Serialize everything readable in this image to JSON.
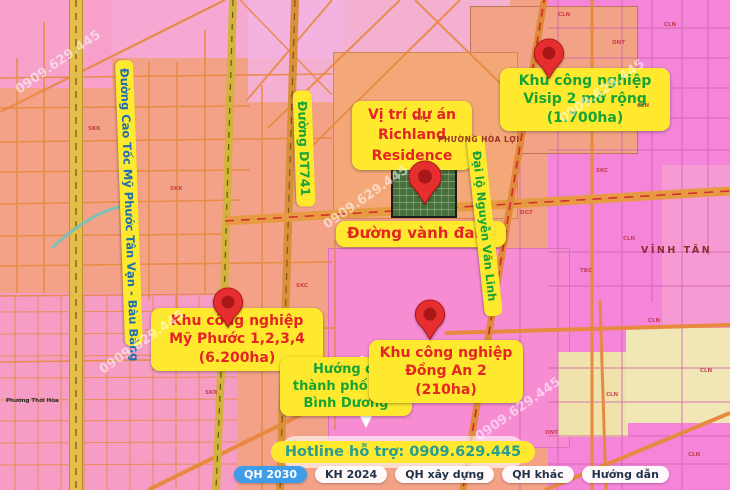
{
  "map": {
    "labels": {
      "visip": {
        "line1": "Khu công nghiệp",
        "line2": "Visip 2 mở rộng",
        "line3": "(1.700ha)"
      },
      "richland": {
        "line1": "Vị trí dự án",
        "line2": "Richland",
        "line3": "Residence"
      },
      "ring_road": "Đường vành đai 4",
      "nguyen_van_linh": "Đại lộ Nguyễn Văn Linh",
      "my_phuoc": {
        "line1": "Khu công nghiệp",
        "line2": "Mỹ Phước 1,2,3,4",
        "line3": "(6.200ha)"
      },
      "direction": {
        "line1": "Hướng đi",
        "line2": "thành phố mới",
        "line3": "Bình Dương"
      },
      "dong_an": {
        "line1": "Khu công nghiệp",
        "line2": "Đồng An 2",
        "line3": "(210ha)"
      },
      "expressway": "Đường Cao Tốc Mỹ Phước Tân Vạn - Bàu Bàng",
      "dt741": "Đường DT741",
      "ward_hoa_loi": "PHƯỜNG HÒA LỢI",
      "vinh_tan": "VĨNH TÂN",
      "ward_thoi_hoa": "Phường Thới Hòa"
    },
    "watermark_text": "0909.629.445",
    "zone_codes": [
      {
        "t": "SKK",
        "x": 88,
        "y": 126
      },
      {
        "t": "SKK",
        "x": 170,
        "y": 186
      },
      {
        "t": "SKR",
        "x": 205,
        "y": 390
      },
      {
        "t": "SKC",
        "x": 296,
        "y": 283
      },
      {
        "t": "CLN",
        "x": 413,
        "y": 116
      },
      {
        "t": "CLN",
        "x": 558,
        "y": 12
      },
      {
        "t": "ONT",
        "x": 612,
        "y": 40
      },
      {
        "t": "CLN",
        "x": 664,
        "y": 22
      },
      {
        "t": "CLN",
        "x": 637,
        "y": 103
      },
      {
        "t": "SKC",
        "x": 596,
        "y": 168
      },
      {
        "t": "CLN",
        "x": 623,
        "y": 236
      },
      {
        "t": "TBC",
        "x": 580,
        "y": 268
      },
      {
        "t": "CLN",
        "x": 648,
        "y": 318
      },
      {
        "t": "CLN",
        "x": 700,
        "y": 368
      },
      {
        "t": "CLN",
        "x": 606,
        "y": 392
      },
      {
        "t": "ONT",
        "x": 545,
        "y": 430
      },
      {
        "t": "CLN",
        "x": 688,
        "y": 452
      },
      {
        "t": "DGT",
        "x": 520,
        "y": 210
      }
    ]
  },
  "footer": {
    "hotline": "Hotline hỗ trợ: 0909.629.445",
    "tabs": [
      {
        "label": "QH 2030",
        "active": true
      },
      {
        "label": "KH 2024",
        "active": false
      },
      {
        "label": "QH xây dựng",
        "active": false
      },
      {
        "label": "QH khác",
        "active": false
      },
      {
        "label": "Hướng dẫn",
        "active": false
      }
    ]
  },
  "colors": {
    "label_bg": "#ffe92e",
    "red_text": "#e42525",
    "green_text": "#17a336",
    "expressway_text": "#1c6fb0",
    "hotline_text": "#2a9d8f",
    "active_tab_bg": "#3f9ce8",
    "pin_red": "#e62e2e"
  }
}
